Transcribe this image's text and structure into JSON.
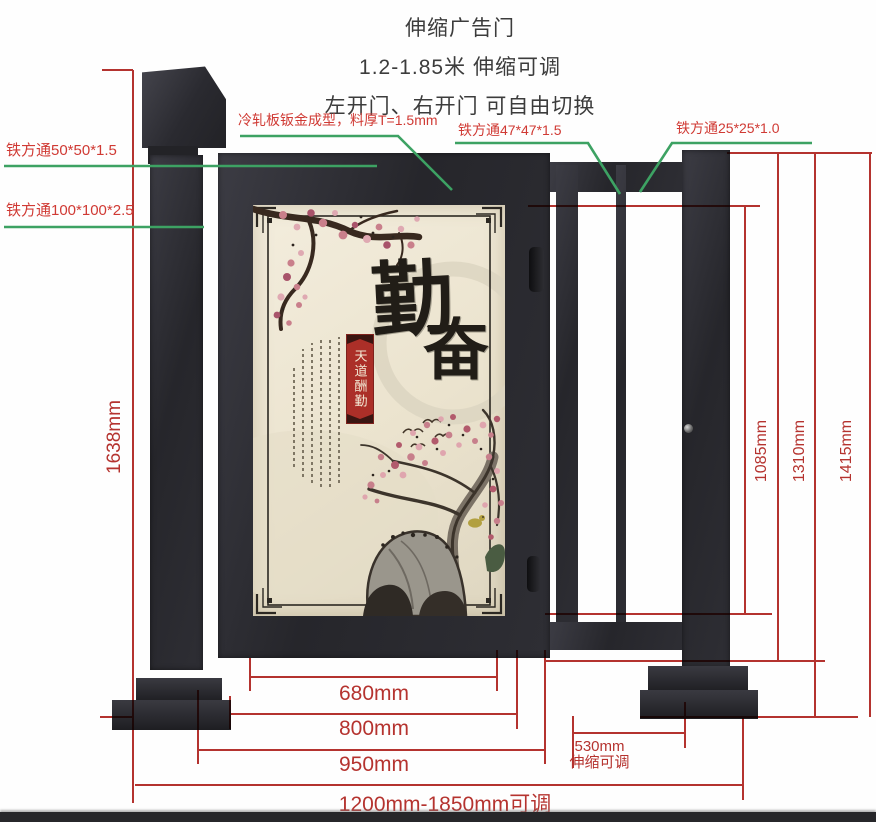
{
  "title": {
    "line1": "伸缩广告门",
    "line2": "1.2-1.85米 伸缩可调",
    "line3": "左开门、右开门 可自由切换"
  },
  "callouts": {
    "sheet_metal": "冷轧板钣金成型，料厚T=1.5mm",
    "tube_47": "铁方通47*47*1.5",
    "tube_25": "铁方通25*25*1.0",
    "tube_50": "铁方通50*50*1.5",
    "tube_100": "铁方通100*100*2.5"
  },
  "dimensions": {
    "left_height": "1638mm",
    "right_heights": [
      "1085mm",
      "1310mm",
      "1415mm"
    ],
    "bottom": {
      "panel": "680mm",
      "door": "800mm",
      "section": "950mm",
      "retract": "530mm",
      "retract_note": "伸缩可调",
      "overall": "1200mm-1850mm可调"
    }
  },
  "artwork": {
    "char_top": "勤",
    "char_bottom": "奋",
    "banner": "天道酬勤"
  },
  "colors": {
    "annotation_red": "#b5332f",
    "annotation_green": "#3da263",
    "callout_red": "#d03a34",
    "structure_dark": "#2a2a2e",
    "panel_cream": "#ece5d2"
  }
}
